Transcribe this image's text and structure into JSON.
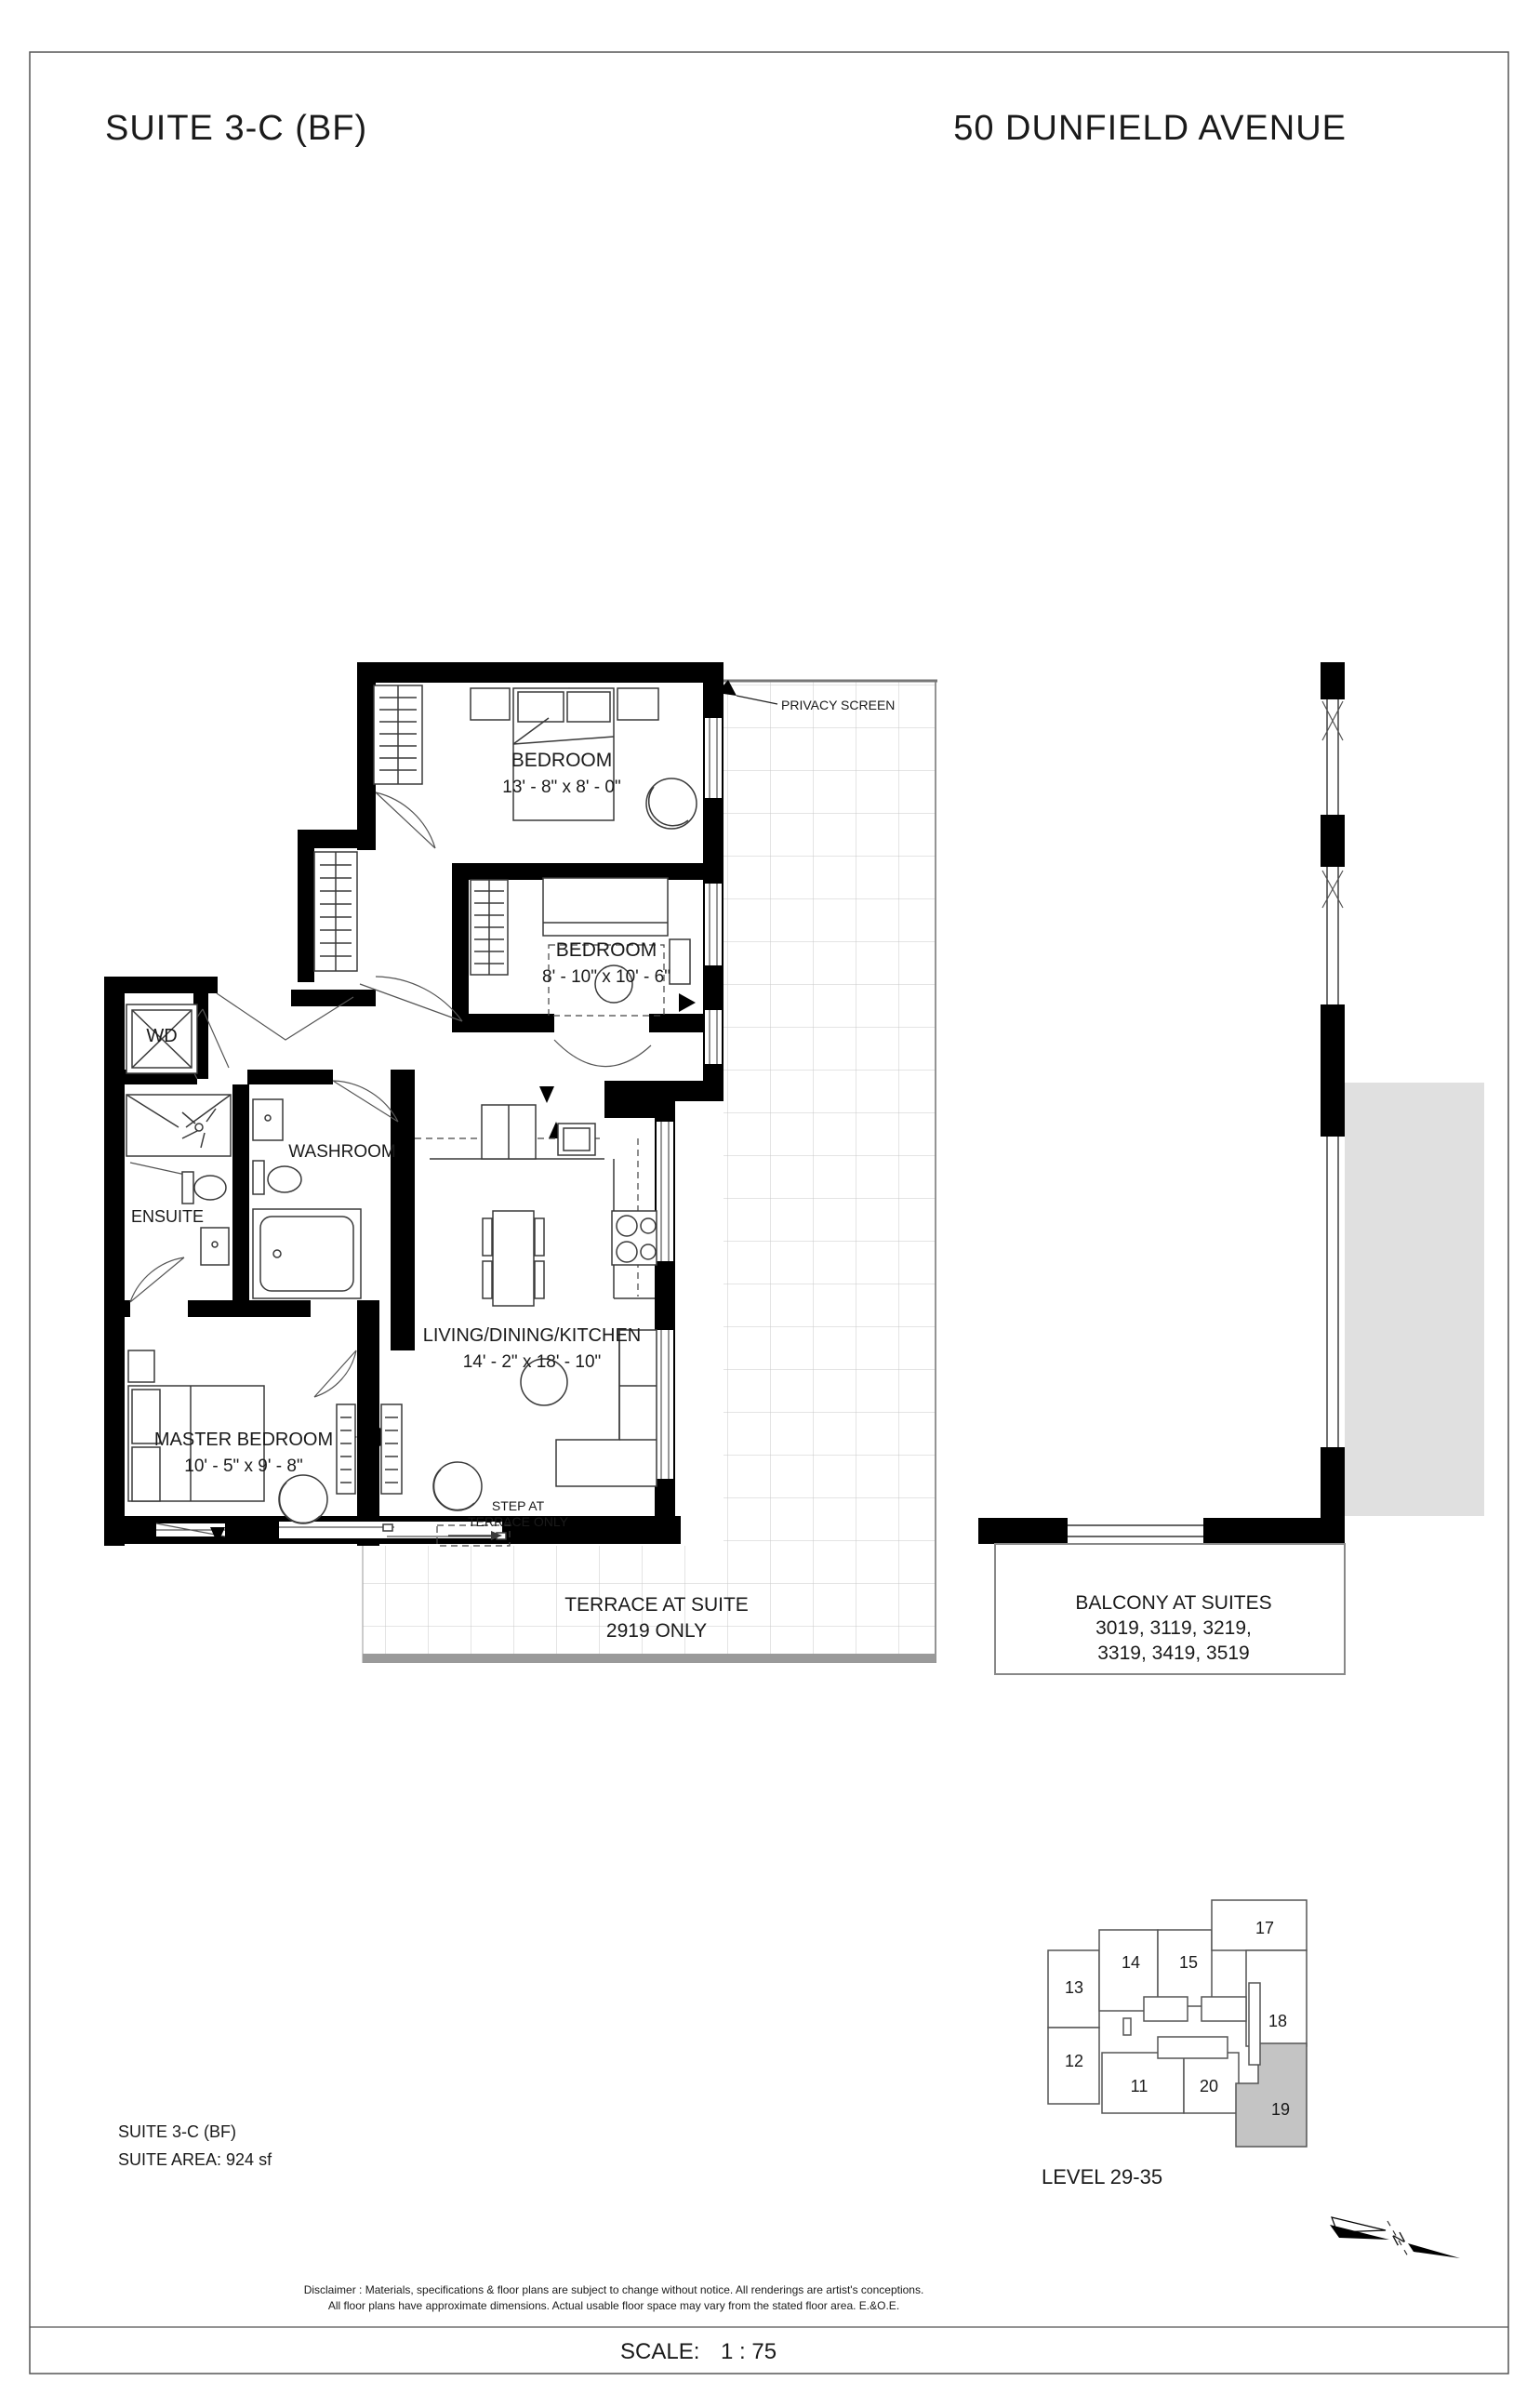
{
  "header": {
    "suite_title": "SUITE  3-C (BF)",
    "address": "50 DUNFIELD AVENUE"
  },
  "rooms": {
    "bedroom1": {
      "label": "BEDROOM",
      "dims": "13' - 8\"  x  8' - 0\""
    },
    "bedroom2": {
      "label": "BEDROOM",
      "dims": "8' - 10\"  x  10' - 6\""
    },
    "master": {
      "label": "MASTER BEDROOM",
      "dims": "10' - 5\"  x  9' - 8\""
    },
    "living": {
      "label": "LIVING/DINING/KITCHEN",
      "dims": "14' - 2\"  x  18' - 10\""
    },
    "washroom": {
      "label": "WASHROOM"
    },
    "ensuite": {
      "label": "ENSUITE"
    },
    "wd": {
      "label": "WD"
    }
  },
  "annotations": {
    "privacy_screen": "PRIVACY SCREEN",
    "step": {
      "line1": "STEP AT",
      "line2": "TERRACE ONLY"
    },
    "terrace": {
      "line1": "TERRACE AT SUITE",
      "line2": "2919 ONLY"
    },
    "balcony": {
      "line1": "BALCONY AT SUITES",
      "line2": "3019, 3119, 3219,",
      "line3": "3319, 3419, 3519"
    }
  },
  "keyplan": {
    "units": [
      {
        "label": "13"
      },
      {
        "label": "14"
      },
      {
        "label": "15"
      },
      {
        "label": "17"
      },
      {
        "label": "18"
      },
      {
        "label": "12"
      },
      {
        "label": "11"
      },
      {
        "label": "20"
      },
      {
        "label": "19"
      }
    ],
    "level": "LEVEL 29-35",
    "north_label": "N",
    "highlight_color": "#c4c4c4"
  },
  "footer": {
    "suite_line": "SUITE  3-C (BF)",
    "area_line": "SUITE AREA: 924 sf",
    "disclaimer_line1": "Disclaimer : Materials, specifications & floor plans are subject to change without notice. All renderings are artist's conceptions.",
    "disclaimer_line2": "All floor plans have approximate dimensions. Actual usable floor space may vary from the stated floor area. E.&O.E.",
    "scale_label": "SCALE:",
    "scale_value": "1 : 75"
  }
}
